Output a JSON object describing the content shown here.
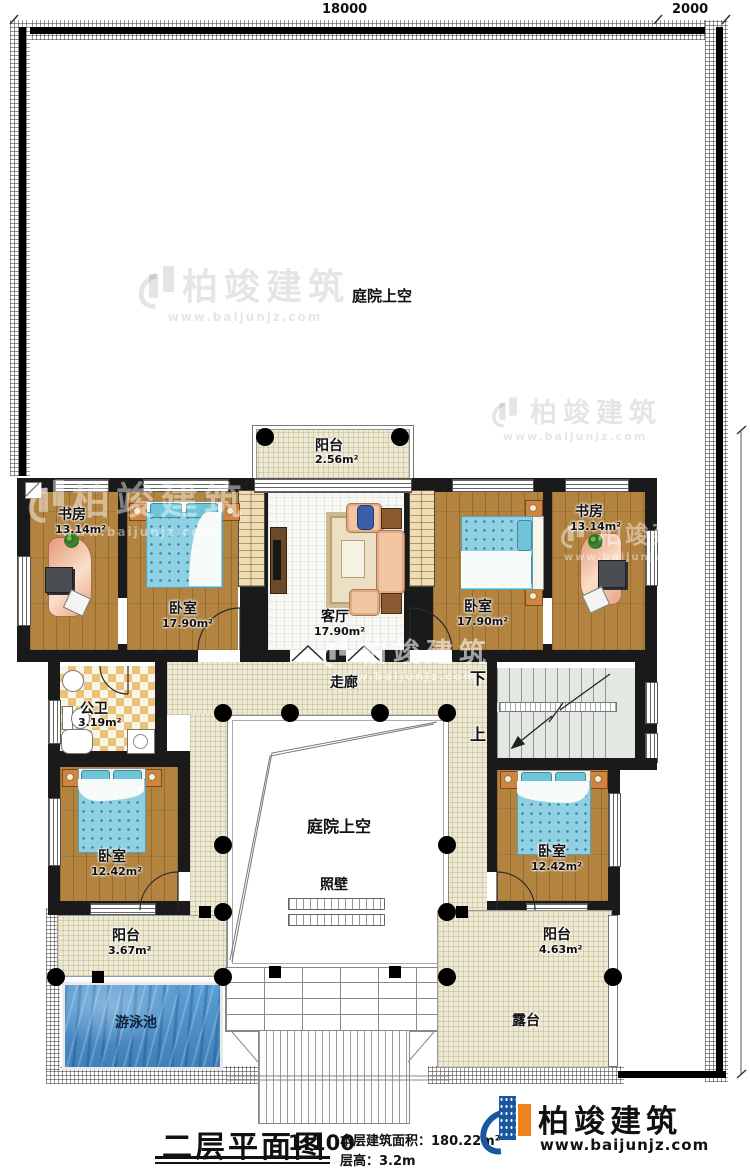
{
  "dimensions": {
    "top_width": "18000",
    "top_right": "2000",
    "right_height": "18500"
  },
  "front_yard": {
    "label": "庭院上空"
  },
  "rooms": {
    "study_left": {
      "name": "书房",
      "area": "13.14m²"
    },
    "bedroom_nw": {
      "name": "卧室",
      "area": "17.90m²"
    },
    "balcony_north": {
      "name": "阳台",
      "area": "2.56m²"
    },
    "living": {
      "name": "客厅",
      "area": "17.90m²"
    },
    "bedroom_ne": {
      "name": "卧室",
      "area": "17.90m²"
    },
    "study_right": {
      "name": "书房",
      "area": "13.14m²"
    },
    "bathroom": {
      "name": "公卫",
      "area": "3.19m²"
    },
    "corridor": {
      "name": "走廊"
    },
    "bedroom_sw": {
      "name": "卧室",
      "area": "12.42m²"
    },
    "bedroom_se": {
      "name": "卧室",
      "area": "12.42m²"
    },
    "courtyard": {
      "name": "庭院上空"
    },
    "screen_wall": {
      "name": "照壁"
    },
    "balcony_sw": {
      "name": "阳台",
      "area": "3.67m²"
    },
    "balcony_se": {
      "name": "阳台",
      "area": "4.63m²"
    },
    "pool": {
      "name": "游泳池"
    },
    "terrace": {
      "name": "露台"
    }
  },
  "stairs": {
    "up": "上",
    "down": "下"
  },
  "title_block": {
    "title": "二层平面图",
    "scale": "1:100",
    "area_label": "本层建筑面积：",
    "area_value": "180.22m²",
    "floor_height_label": "层高：",
    "floor_height_value": "3.2m"
  },
  "brand": {
    "name": "柏竣建筑",
    "url": "www.baijunjz.com"
  },
  "watermark": {
    "name": "柏竣建筑",
    "url": "www.baijunjz.com"
  },
  "colors": {
    "wall": "#1a1a1a",
    "wood_floor": "#b28440",
    "walkway": "#eee9d3",
    "water": "#4a8fc7",
    "blanket": "#8fd0e2",
    "desk": "#eda985",
    "brand_blue": "#1a57a0",
    "brand_orange": "#f0821e"
  }
}
